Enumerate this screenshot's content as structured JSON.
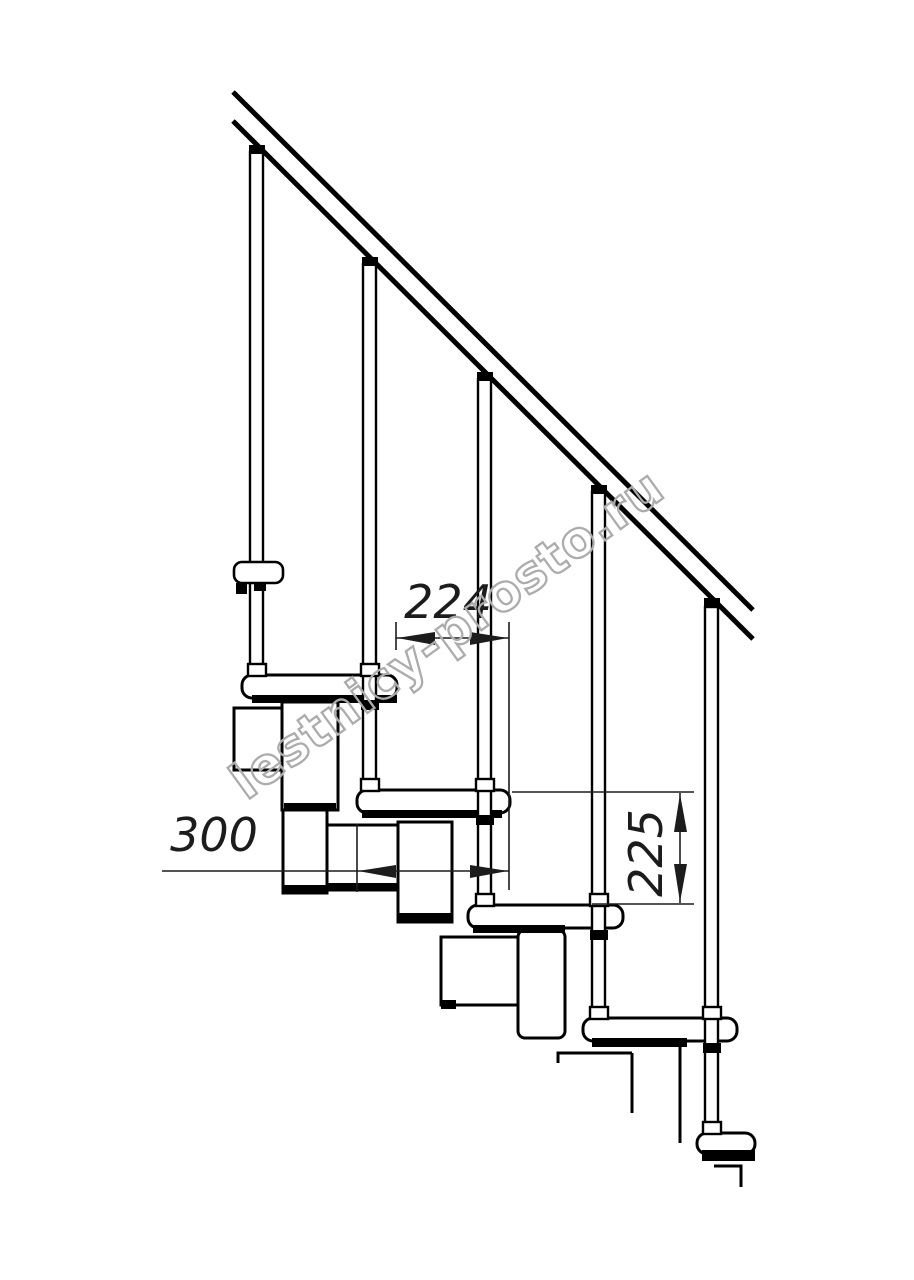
{
  "canvas": {
    "width": 914,
    "height": 1280
  },
  "colors": {
    "background": "#ffffff",
    "ink": "#000000",
    "dim_ink": "#1c1c1c",
    "watermark": "#acacac"
  },
  "labels": {
    "dim_run": "224",
    "dim_depth": "300",
    "dim_rise": "225",
    "watermark": "lestnicy-prosto.ru"
  },
  "drawing": {
    "primitives": [
      {
        "t": "rect",
        "n": "spine-box-upper",
        "x": 234,
        "y": 708,
        "w": 57,
        "h": 62,
        "sw": 3
      },
      {
        "t": "rect",
        "n": "spine-connector-1",
        "x": 282,
        "y": 702,
        "w": 56,
        "h": 108,
        "sw": 3
      },
      {
        "t": "rect",
        "n": "spine-bottom-bar",
        "x": 284,
        "y": 803,
        "w": 52,
        "h": 8,
        "f": "black"
      },
      {
        "t": "rect",
        "n": "spine-connector-1-lower",
        "x": 283,
        "y": 810,
        "w": 44,
        "h": 83,
        "sw": 3
      },
      {
        "t": "rect",
        "n": "spine-bottom-bar",
        "x": 284,
        "y": 885,
        "w": 42,
        "h": 8,
        "f": "black"
      },
      {
        "t": "rect",
        "n": "spine-box-2",
        "x": 327,
        "y": 825,
        "w": 76,
        "h": 65,
        "sw": 3
      },
      {
        "t": "rect",
        "n": "spine-bottom-bar",
        "x": 328,
        "y": 883,
        "w": 74,
        "h": 7,
        "f": "black"
      },
      {
        "t": "rect",
        "n": "spine-connector-2",
        "x": 398,
        "y": 822,
        "w": 54,
        "h": 100,
        "sw": 3
      },
      {
        "t": "rect",
        "n": "spine-bottom-bar",
        "x": 399,
        "y": 913,
        "w": 52,
        "h": 9,
        "f": "black"
      },
      {
        "t": "rect",
        "n": "spine-box-3",
        "x": 441,
        "y": 937,
        "w": 77,
        "h": 68,
        "sw": 3
      },
      {
        "t": "rect",
        "n": "spine-bottom-bar",
        "x": 441,
        "y": 1000,
        "w": 15,
        "h": 9,
        "f": "black"
      },
      {
        "t": "rect",
        "n": "spine-connector-3",
        "x": 518,
        "y": 930,
        "w": 47,
        "h": 108,
        "sw": 3,
        "rx": 7
      },
      {
        "t": "path",
        "n": "spine-box-4-outline",
        "d": "M558,1063 L558,1053 L632,1053"
      },
      {
        "t": "path",
        "n": "spine-box-4-outline",
        "d": "M632,1053 L632,1113"
      },
      {
        "t": "path",
        "n": "spine-box-4-outline",
        "d": "M680,1040 L680,1143"
      },
      {
        "t": "path",
        "n": "spine-box-5-outline",
        "d": "M714,1166 L741,1166 L741,1187"
      },
      {
        "t": "rect",
        "n": "tread-1",
        "x": 242,
        "y": 675,
        "w": 155,
        "h": 23,
        "rx": 10,
        "sw": 3
      },
      {
        "t": "rect",
        "n": "tread-underline",
        "x": 252,
        "y": 695,
        "w": 145,
        "h": 8,
        "f": "black"
      },
      {
        "t": "rect",
        "n": "tread-2",
        "x": 357,
        "y": 790,
        "w": 153,
        "h": 23,
        "rx": 10,
        "sw": 3
      },
      {
        "t": "rect",
        "n": "tread-underline",
        "x": 362,
        "y": 810,
        "w": 140,
        "h": 8,
        "f": "black"
      },
      {
        "t": "rect",
        "n": "tread-3",
        "x": 468,
        "y": 905,
        "w": 155,
        "h": 23,
        "rx": 10,
        "sw": 3
      },
      {
        "t": "rect",
        "n": "tread-underline",
        "x": 473,
        "y": 925,
        "w": 92,
        "h": 8,
        "f": "black"
      },
      {
        "t": "rect",
        "n": "tread-4",
        "x": 583,
        "y": 1018,
        "w": 154,
        "h": 23,
        "rx": 10,
        "sw": 3
      },
      {
        "t": "rect",
        "n": "tread-underline",
        "x": 592,
        "y": 1038,
        "w": 95,
        "h": 9,
        "f": "black"
      },
      {
        "t": "rect",
        "n": "tread-5",
        "x": 697,
        "y": 1133,
        "w": 58,
        "h": 21,
        "rx": 10,
        "sw": 3
      },
      {
        "t": "rect",
        "n": "tread-underline",
        "x": 702,
        "y": 1150,
        "w": 53,
        "h": 11,
        "f": "black"
      },
      {
        "t": "rect",
        "n": "baluster-1",
        "x": 250,
        "y": 152,
        "w": 13,
        "h": 523,
        "sw": 2.4
      },
      {
        "t": "rect",
        "n": "baluster-2",
        "x": 363,
        "y": 264,
        "w": 13,
        "h": 526,
        "sw": 2.4
      },
      {
        "t": "rect",
        "n": "baluster-3",
        "x": 478,
        "y": 379,
        "w": 13,
        "h": 526,
        "sw": 2.4
      },
      {
        "t": "rect",
        "n": "baluster-4",
        "x": 592,
        "y": 492,
        "w": 13,
        "h": 526,
        "sw": 2.4
      },
      {
        "t": "rect",
        "n": "baluster-5",
        "x": 705,
        "y": 607,
        "w": 13,
        "h": 524,
        "sw": 2.4
      },
      {
        "t": "rect",
        "n": "tread-bracket",
        "x": 234,
        "y": 562,
        "w": 49,
        "h": 21,
        "rx": 8,
        "sw": 2.6
      },
      {
        "t": "rect",
        "n": "bracket-foot",
        "x": 236,
        "y": 583,
        "w": 11,
        "h": 11,
        "f": "black"
      },
      {
        "t": "rect",
        "n": "bracket-foot",
        "x": 254,
        "y": 583,
        "w": 12,
        "h": 8,
        "f": "black"
      },
      {
        "t": "rect",
        "n": "baluster-cap",
        "x": 249,
        "y": 145,
        "w": 16,
        "h": 9,
        "f": "black"
      },
      {
        "t": "rect",
        "n": "baluster-cap",
        "x": 362,
        "y": 257,
        "w": 16,
        "h": 9,
        "f": "black"
      },
      {
        "t": "rect",
        "n": "baluster-cap",
        "x": 477,
        "y": 372,
        "w": 16,
        "h": 9,
        "f": "black"
      },
      {
        "t": "rect",
        "n": "baluster-cap",
        "x": 591,
        "y": 485,
        "w": 16,
        "h": 9,
        "f": "black"
      },
      {
        "t": "rect",
        "n": "baluster-cap",
        "x": 704,
        "y": 598,
        "w": 16,
        "h": 9,
        "f": "black"
      },
      {
        "t": "rect",
        "n": "coupling-collar",
        "x": 248,
        "y": 664,
        "w": 18,
        "h": 12,
        "sw": 2.4
      },
      {
        "t": "rect",
        "n": "coupling-collar",
        "x": 361,
        "y": 664,
        "w": 18,
        "h": 12,
        "sw": 2.4
      },
      {
        "t": "rect",
        "n": "coupling-collar",
        "x": 361,
        "y": 779,
        "w": 18,
        "h": 12,
        "sw": 2.4
      },
      {
        "t": "rect",
        "n": "coupling-collar",
        "x": 476,
        "y": 779,
        "w": 18,
        "h": 12,
        "sw": 2.4
      },
      {
        "t": "rect",
        "n": "coupling-collar",
        "x": 476,
        "y": 894,
        "w": 18,
        "h": 12,
        "sw": 2.4
      },
      {
        "t": "rect",
        "n": "coupling-collar",
        "x": 590,
        "y": 894,
        "w": 18,
        "h": 12,
        "sw": 2.4
      },
      {
        "t": "rect",
        "n": "coupling-collar",
        "x": 590,
        "y": 1007,
        "w": 18,
        "h": 12,
        "sw": 2.4
      },
      {
        "t": "rect",
        "n": "coupling-collar",
        "x": 703,
        "y": 1007,
        "w": 18,
        "h": 12,
        "sw": 2.4
      },
      {
        "t": "rect",
        "n": "coupling-collar",
        "x": 703,
        "y": 1122,
        "w": 18,
        "h": 12,
        "sw": 2.4
      },
      {
        "t": "rect",
        "n": "baluster-stub",
        "x": 361,
        "y": 700,
        "w": 18,
        "h": 10,
        "f": "black"
      },
      {
        "t": "rect",
        "n": "baluster-stub",
        "x": 476,
        "y": 815,
        "w": 18,
        "h": 10,
        "f": "black"
      },
      {
        "t": "rect",
        "n": "baluster-stub",
        "x": 590,
        "y": 930,
        "w": 18,
        "h": 10,
        "f": "black"
      },
      {
        "t": "rect",
        "n": "baluster-stub",
        "x": 703,
        "y": 1043,
        "w": 18,
        "h": 10,
        "f": "black"
      },
      {
        "t": "line",
        "n": "handrail-top-line",
        "x1": 233,
        "y1": 92,
        "x2": 753,
        "y2": 610,
        "w": 5
      },
      {
        "t": "line",
        "n": "handrail-bottom-line",
        "x1": 233,
        "y1": 121,
        "x2": 753,
        "y2": 639,
        "w": 5
      },
      {
        "t": "line",
        "n": "extension-line",
        "x1": 396,
        "y1": 622,
        "x2": 396,
        "y2": 650,
        "w": 1.6
      },
      {
        "t": "line",
        "n": "extension-line",
        "x1": 509,
        "y1": 622,
        "x2": 509,
        "y2": 890,
        "w": 1.6
      },
      {
        "t": "line",
        "n": "extension-line",
        "x1": 357,
        "y1": 824,
        "x2": 357,
        "y2": 892,
        "w": 1.6
      },
      {
        "t": "line",
        "n": "extension-line",
        "x1": 512,
        "y1": 792,
        "x2": 694,
        "y2": 792,
        "w": 1.6
      },
      {
        "t": "line",
        "n": "extension-line",
        "x1": 592,
        "y1": 904,
        "x2": 694,
        "y2": 904,
        "w": 1.6
      },
      {
        "t": "line",
        "n": "dimension-line-224",
        "x1": 396,
        "y1": 638,
        "x2": 509,
        "y2": 638,
        "w": 1.6
      },
      {
        "t": "line",
        "n": "dimension-line-300",
        "x1": 162,
        "y1": 871,
        "x2": 509,
        "y2": 871,
        "w": 1.6
      },
      {
        "t": "line",
        "n": "dimension-line-225",
        "x1": 680,
        "y1": 793,
        "x2": 680,
        "y2": 903,
        "w": 1.6
      },
      {
        "t": "poly",
        "n": "dimension-arrow-left",
        "pts": "397,638 435,632 435,645"
      },
      {
        "t": "poly",
        "n": "dimension-arrow-right",
        "pts": "508,638 470,632 470,645"
      },
      {
        "t": "poly",
        "n": "dimension-arrow-left",
        "pts": "358,871 396,865 396,878"
      },
      {
        "t": "poly",
        "n": "dimension-arrow-right",
        "pts": "508,871 470,865 470,878"
      },
      {
        "t": "poly",
        "n": "dimension-arrow-up",
        "pts": "680,794 674,832 687,832"
      },
      {
        "t": "poly",
        "n": "dimension-arrow-down",
        "pts": "680,902 674,864 687,864"
      },
      {
        "t": "text",
        "n": "dimension-label-224",
        "label": "dim_run",
        "x": 448,
        "y": 618,
        "fs": 46,
        "style": "dim"
      },
      {
        "t": "text",
        "n": "dimension-label-300",
        "label": "dim_depth",
        "x": 214,
        "y": 851,
        "fs": 46,
        "style": "dim"
      },
      {
        "t": "text",
        "n": "dimension-label-225",
        "label": "dim_rise",
        "x": 0,
        "y": 0,
        "fs": 46,
        "style": "dim",
        "tf": "translate(662,853) rotate(-90)"
      },
      {
        "t": "text",
        "n": "watermark-text",
        "label": "watermark",
        "x": 0,
        "y": 0,
        "fs": 50,
        "style": "watermark",
        "tf": "translate(457,648) rotate(-36)"
      }
    ]
  }
}
